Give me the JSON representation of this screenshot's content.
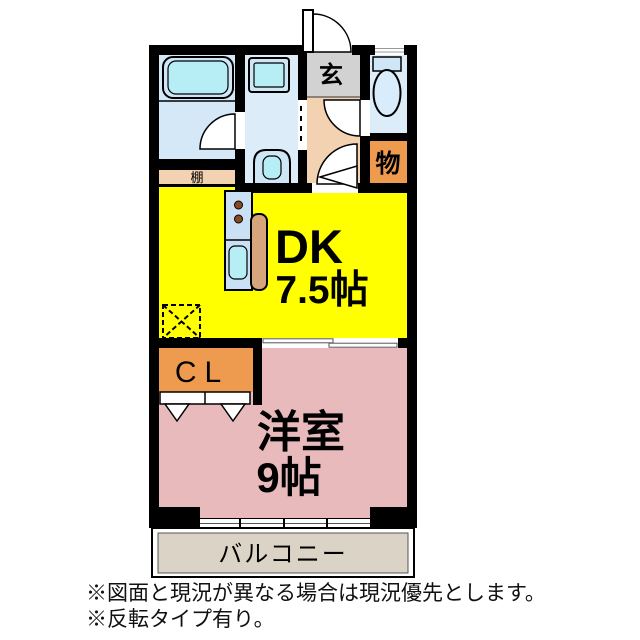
{
  "floorplan": {
    "rooms": {
      "entrance_label": "玄",
      "hall_shelf_label": "棚",
      "storage_label": "物",
      "dk_label": "DK",
      "dk_size": "7.5帖",
      "closet_label": "CL",
      "western_room_label": "洋室",
      "western_room_size": "9帖",
      "balcony_label": "バルコニー"
    },
    "fixtures": [
      "bathtub",
      "washing-machine",
      "washbasin",
      "toilet",
      "kitchen-stove",
      "kitchen-sink",
      "kitchen-counter",
      "refrigerator-space"
    ],
    "colors": {
      "wall": "#000000",
      "dk_fill": "#ffff00",
      "western_room_fill": "#e8babc",
      "closet_fill": "#ee9b50",
      "storage_fill": "#ee9b50",
      "hall_fill": "#f3d2b1",
      "entrance_fill": "#d2d2d2",
      "wet_room_fill": "#d9eafa",
      "fixture_cyan": "#b7edf4",
      "counter_tan": "#d6a57c",
      "balcony_fill": "#dbd4c6"
    },
    "notes": [
      "※図面と現況が異なる場合は現況優先とします。",
      "※反転タイプ有り。"
    ]
  }
}
